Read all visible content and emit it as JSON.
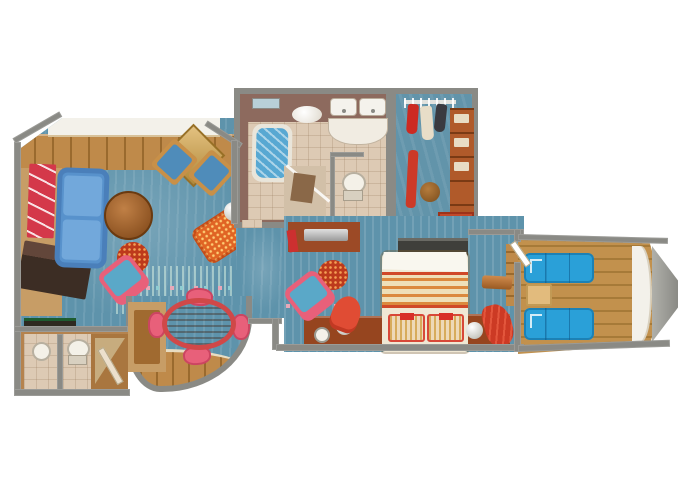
{
  "title": "Cruise ship suite floor plan with private balconies",
  "palette": {
    "wall": "#8a8a85",
    "wall_light": "#b6b6b0",
    "carpet": "#5e93ab",
    "carpet_light": "#7fb0c0",
    "wood": "#bf8a4a",
    "wood_dark": "#9a6a2e",
    "deck": "#c2914d",
    "deck_dark": "#a67a38",
    "tan": "#c79d66",
    "tile": "#ddcab4",
    "bath_wall": "#8d6a5e",
    "water": "#58a8d2",
    "sofa_blue": "#5892cc",
    "lounger_blue": "#2aa0d8",
    "pink": "#e8607a",
    "accent_red": "#c23520",
    "accent_orange": "#e06424",
    "bed_cream": "#f0e8d4",
    "plant_green": "#1c5c38",
    "silver": "#c9c9c2",
    "white_trim": "#f3f1ea"
  },
  "rooms": {
    "living": {
      "name": "Living room",
      "furniture": [
        "wall-art",
        "sofa",
        "coffee-table",
        "ottoman",
        "armchair",
        "window-chairs",
        "corner-table",
        "chaise-lounge",
        "sphere-lamp",
        "plant",
        "privacy-curtain",
        "writing-desk",
        "minibar",
        "front-balcony"
      ]
    },
    "dining": {
      "name": "Dining bay",
      "furniture": [
        "oval-dining-table",
        "dining-chairs",
        "storage-cabinet",
        "bay-window-floor"
      ]
    },
    "guest_wc": {
      "name": "Guest washroom and entry",
      "furniture": [
        "sink",
        "toilet",
        "entry-door"
      ]
    },
    "bathroom": {
      "name": "Master bathroom",
      "furniture": [
        "bathtub",
        "double-sinks",
        "vanity",
        "shower",
        "toilet",
        "ceiling-light"
      ]
    },
    "closet": {
      "name": "Walk-in closet",
      "furniture": [
        "hanging-rail",
        "garments",
        "shelving",
        "stool",
        "runner-rug",
        "shoe-rack",
        "drawers"
      ]
    },
    "bedroom": {
      "name": "Master bedroom",
      "furniture": [
        "double-bed",
        "pillows",
        "nightstands",
        "sphere-lamps",
        "tv-dresser",
        "vanity-dresser",
        "armchair",
        "ottoman",
        "slipper-chair",
        "luggage-bench",
        "balcony-door"
      ]
    },
    "balcony": {
      "name": "Private balcony",
      "furniture": [
        "sun-lounger",
        "sun-lounger",
        "side-table",
        "railing"
      ]
    }
  }
}
